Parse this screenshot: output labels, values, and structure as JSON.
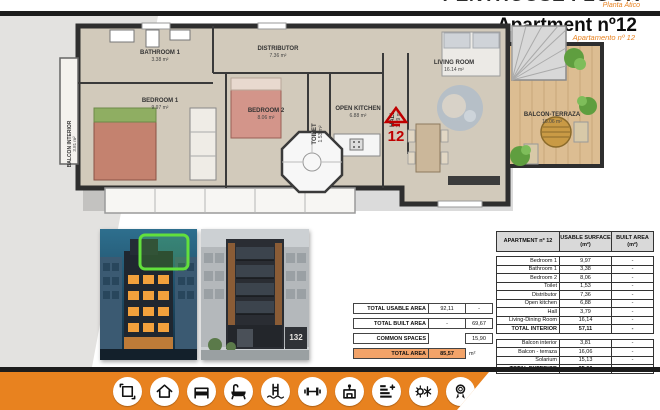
{
  "header": {
    "top_title": "PENTHOUSE FLOOR",
    "top_subtitle": "Planta Ático",
    "title": "Apartment nº12",
    "subtitle": "Apartamento nº 12"
  },
  "floor_plan": {
    "unit_number": "12",
    "rooms": [
      {
        "name": "balcon-interior",
        "label": "BALCON INTERIOR",
        "area": "3.81 m²"
      },
      {
        "name": "bathroom-1",
        "label": "BATHROOM 1",
        "area": "3.38 m²"
      },
      {
        "name": "bedroom-1",
        "label": "BEDROOM 1",
        "area": "9.97 m²"
      },
      {
        "name": "distributor",
        "label": "DISTRIBUTOR",
        "area": "7.36 m²"
      },
      {
        "name": "bedroom-2",
        "label": "BEDROOM 2",
        "area": "8.06 m²"
      },
      {
        "name": "toilet",
        "label": "TOILET",
        "area": "1.53 m²"
      },
      {
        "name": "open-kitchen",
        "label": "OPEN KITCHEN",
        "area": "6.88 m²"
      },
      {
        "name": "hall",
        "label": "HALL",
        "area": "3.79 m²"
      },
      {
        "name": "living-room",
        "label": "LIVING ROOM",
        "area": "16.14 m²"
      },
      {
        "name": "balcon-terraza",
        "label": "BALCON-TERRAZA",
        "area": "16.06 m²"
      }
    ]
  },
  "photos": [
    {
      "name": "night-render",
      "highlight": "apartment-12-location"
    },
    {
      "name": "day-render",
      "building_number": "132"
    }
  ],
  "summary": {
    "rows": [
      {
        "label": "TOTAL USABLE AREA",
        "usable": "92,11",
        "built": "-"
      },
      {
        "label": "TOTAL BUILT AREA",
        "usable": "-",
        "built": "69,67"
      },
      {
        "label": "COMMON SPACES",
        "usable": "",
        "built": "15,90"
      }
    ],
    "total": {
      "label": "TOTAL AREA",
      "value": "85,57",
      "unit": "m²"
    }
  },
  "table": {
    "headers": {
      "col1": "APARTMENT nº 12",
      "col2": "USABLE SURFACE",
      "col2_unit": "(m²)",
      "col3": "BUILT AREA",
      "col3_unit": "(m²)"
    },
    "interior_rows": [
      {
        "label": "Bedroom 1",
        "usable": "9,97",
        "built": "-",
        "total": false
      },
      {
        "label": "Bathroom 1",
        "usable": "3,38",
        "built": "-",
        "total": false
      },
      {
        "label": "Bedroom 2",
        "usable": "8,06",
        "built": "-",
        "total": false
      },
      {
        "label": "Toilet",
        "usable": "1,53",
        "built": "-",
        "total": false
      },
      {
        "label": "Distributor",
        "usable": "7,36",
        "built": "-",
        "total": false
      },
      {
        "label": "Open kitchen",
        "usable": "6,88",
        "built": "-",
        "total": false
      },
      {
        "label": "Hall",
        "usable": "3,79",
        "built": "-",
        "total": false
      },
      {
        "label": "Living-Dining Room",
        "usable": "16,14",
        "built": "-",
        "total": false
      },
      {
        "label": "TOTAL INTERIOR",
        "usable": "57,11",
        "built": "-",
        "total": true
      }
    ],
    "exterior_rows": [
      {
        "label": "Balcon interior",
        "usable": "3,81",
        "built": "-",
        "total": false
      },
      {
        "label": "Balcon - terraza",
        "usable": "16,06",
        "built": "-",
        "total": false
      },
      {
        "label": "Solarium",
        "usable": "15,13",
        "built": "-",
        "total": false
      },
      {
        "label": "TOTAL EXTERIOR",
        "usable": "35,00",
        "built": "-",
        "total": true
      }
    ]
  },
  "icons": [
    {
      "name": "dimensions-icon"
    },
    {
      "name": "home-icon"
    },
    {
      "name": "bed-icon"
    },
    {
      "name": "bathtub-icon"
    },
    {
      "name": "pool-icon"
    },
    {
      "name": "gym-icon"
    },
    {
      "name": "building-icon"
    },
    {
      "name": "energy-rating-icon"
    },
    {
      "name": "climate-icon"
    },
    {
      "name": "award-icon"
    }
  ],
  "colors": {
    "accent_orange": "#E8821F",
    "marker_red": "#C00000",
    "highlight_green": "#6BE33A",
    "table_header_gray": "#D9D9D9",
    "total_area_fill": "#F2A369"
  }
}
